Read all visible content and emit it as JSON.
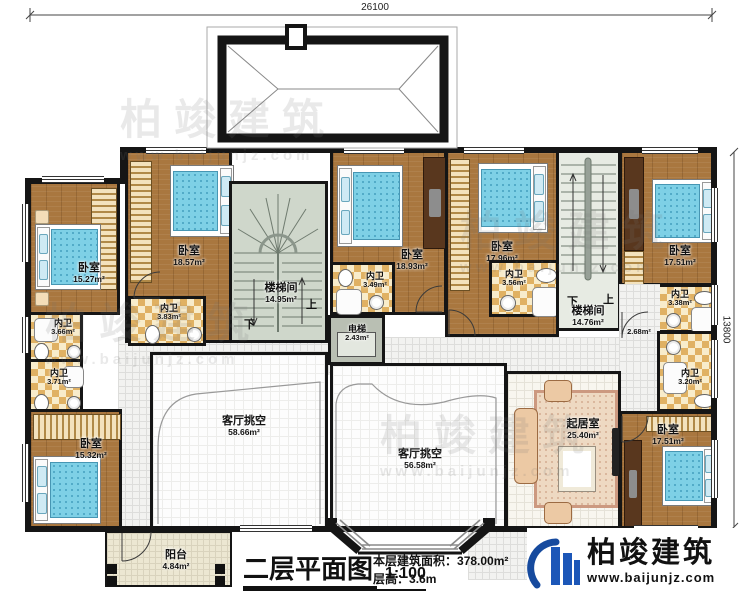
{
  "dimensions": {
    "top": "26100",
    "right": "13800"
  },
  "plan_info": {
    "title": "二层平面图",
    "scale": "1:100",
    "area_label": "本层建筑面积：",
    "area_value": "378.00m²",
    "floor_height_label": "层高：",
    "floor_height_value": "3.6m"
  },
  "branding": {
    "company": "柏竣建筑",
    "website": "www.baijunjz.com"
  },
  "watermark": {
    "text": "柏竣建筑",
    "subtext": "www.baijunjz.com"
  },
  "stairs": {
    "up": "上",
    "down": "下"
  },
  "colors": {
    "wall": "#151515",
    "wood_floor": "#a9773f",
    "bed": "#7ed0e6",
    "stair_floor": "#cfd7cb",
    "brand_blue": "#1a4fa0"
  },
  "rooms": {
    "bedroom_nw": {
      "name": "卧室",
      "area": "15.27m²"
    },
    "bedroom_n1": {
      "name": "卧室",
      "area": "18.57m²"
    },
    "bath_n1": {
      "name": "内卫",
      "area": "3.83m²"
    },
    "bath_w1": {
      "name": "内卫",
      "area": "3.66m²"
    },
    "bath_w2": {
      "name": "内卫",
      "area": "3.71m²"
    },
    "bedroom_sw": {
      "name": "卧室",
      "area": "15.32m²"
    },
    "stair_west": {
      "name": "楼梯间",
      "area": "14.95m²"
    },
    "elevator": {
      "name": "电梯",
      "area": "2.43m²"
    },
    "bedroom_n2": {
      "name": "卧室",
      "area": "18.93m²"
    },
    "bath_n2": {
      "name": "内卫",
      "area": "3.49m²"
    },
    "bedroom_n3": {
      "name": "卧室",
      "area": "17.96m²"
    },
    "bath_n3": {
      "name": "内卫",
      "area": "3.56m²"
    },
    "stair_east": {
      "name": "楼梯间",
      "area": "14.76m²"
    },
    "bedroom_ne": {
      "name": "卧室",
      "area": "17.51m²"
    },
    "bath_e1": {
      "name": "内卫",
      "area": "3.38m²"
    },
    "hall_e": {
      "area": "2.68m²"
    },
    "bath_e2": {
      "name": "内卫",
      "area": "3.20m²"
    },
    "bedroom_se": {
      "name": "卧室",
      "area": "17.51m²"
    },
    "living": {
      "name": "起居室",
      "area": "25.40m²"
    },
    "void_west": {
      "name": "客厅挑空",
      "area": "58.66m²"
    },
    "void_east": {
      "name": "客厅挑空",
      "area": "56.58m²"
    },
    "balcony": {
      "name": "阳台",
      "area": "4.84m²"
    }
  }
}
